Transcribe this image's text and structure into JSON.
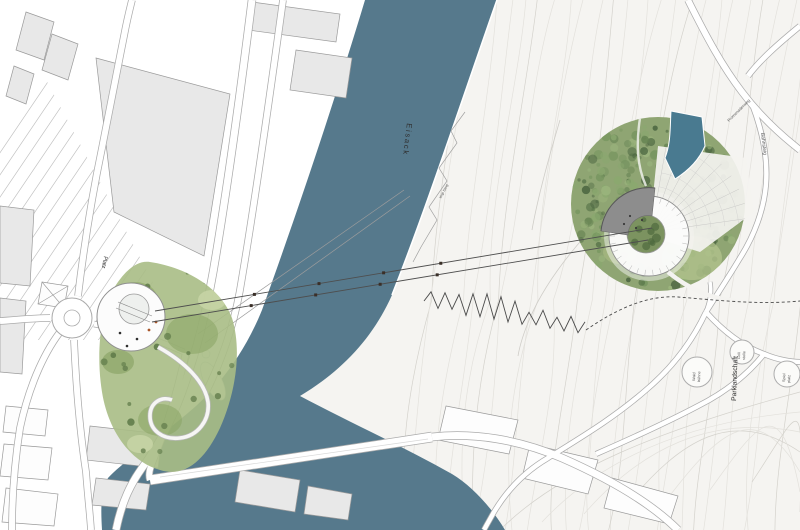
{
  "map": {
    "river_label": "Eisack",
    "plaza_label": "Platz",
    "parkland_label": "Parklandschaft",
    "trail_label": "Virgl Steig",
    "upper_road_label": "Promenadenweg",
    "hill_path_label": "Bahnsteig",
    "park_nodes": [
      {
        "line1": "Wald",
        "line2": "bühne"
      },
      {
        "line1": "Grill",
        "line2": "stelle"
      },
      {
        "line1": "Spiel",
        "line2": "platz"
      }
    ],
    "colors": {
      "river": "#56798c",
      "hill": "#f5f4f1",
      "contour": "#e3e1dc",
      "contour_major": "#d4d2cc",
      "building_fill": "#e8e8e8",
      "building_stroke": "#9a9a9a",
      "road_casing": "#ababab",
      "roof_gray": "#8d8d8d",
      "water_feature": "#497a90",
      "cable": "#4e4e4e",
      "sketch": "#4a4a4a",
      "park_greens": [
        "#a9bd85",
        "#86a25f",
        "#c9d6a8"
      ],
      "forest_palette": [
        "#4d6742",
        "#5a764b",
        "#688554",
        "#779660",
        "#8aa86f",
        "#9cb67e"
      ]
    }
  }
}
